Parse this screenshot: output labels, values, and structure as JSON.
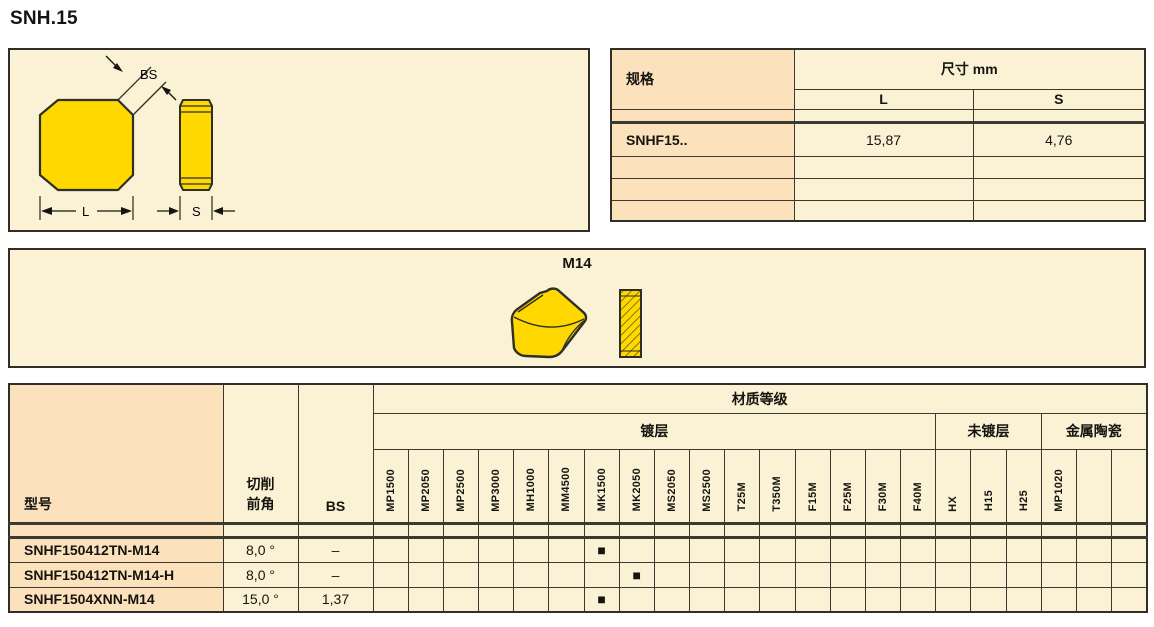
{
  "page_title": "SNH.15",
  "colors": {
    "panel_cream": "#FBF2D5",
    "header_peach": "#FCE2BC",
    "insert_yellow": "#FFD800",
    "line_dark": "#2F2E27",
    "mark_black": "#15140F"
  },
  "insert_drawing": {
    "labels": {
      "bs": "BS",
      "l": "L",
      "s": "S"
    }
  },
  "dimension_table": {
    "col_spec": "规格",
    "dim_header": "尺寸 mm",
    "col_l": "L",
    "col_s": "S",
    "rows": [
      {
        "spec": "",
        "l": "",
        "s": ""
      },
      {
        "spec": "SNHF15..",
        "l": "15,87",
        "s": "4,76"
      },
      {
        "spec": "",
        "l": "",
        "s": ""
      },
      {
        "spec": "",
        "l": "",
        "s": ""
      },
      {
        "spec": "",
        "l": "",
        "s": ""
      }
    ]
  },
  "chipbreaker_panel": {
    "label": "M14"
  },
  "grades_table": {
    "col_model": "型号",
    "rake_line1": "切削",
    "rake_line2": "前角",
    "col_bs": "BS",
    "group_header": "材质等级",
    "subgroups": [
      {
        "label": "镀层",
        "span": 16
      },
      {
        "label": "未镀层",
        "span": 3
      },
      {
        "label": "金属陶瓷",
        "span": 3
      }
    ],
    "grade_columns": [
      "MP1500",
      "MP2050",
      "MP2500",
      "MP3000",
      "MH1000",
      "MM4500",
      "MK1500",
      "MK2050",
      "MS2050",
      "MS2500",
      "T25M",
      "T350M",
      "F15M",
      "F25M",
      "F30M",
      "F40M",
      "HX",
      "H15",
      "H25",
      "MP1020",
      "",
      ""
    ],
    "marker": "■",
    "rows": [
      {
        "model": "",
        "rake": "",
        "bs": "",
        "marks": []
      },
      {
        "model": "SNHF150412TN-M14",
        "rake": "8,0 °",
        "bs": "–",
        "marks": [
          "MK1500"
        ]
      },
      {
        "model": "SNHF150412TN-M14-H",
        "rake": "8,0 °",
        "bs": "–",
        "marks": [
          "MK2050"
        ]
      },
      {
        "model": "SNHF1504XNN-M14",
        "rake": "15,0 °",
        "bs": "1,37",
        "marks": [
          "MK1500"
        ]
      }
    ]
  }
}
